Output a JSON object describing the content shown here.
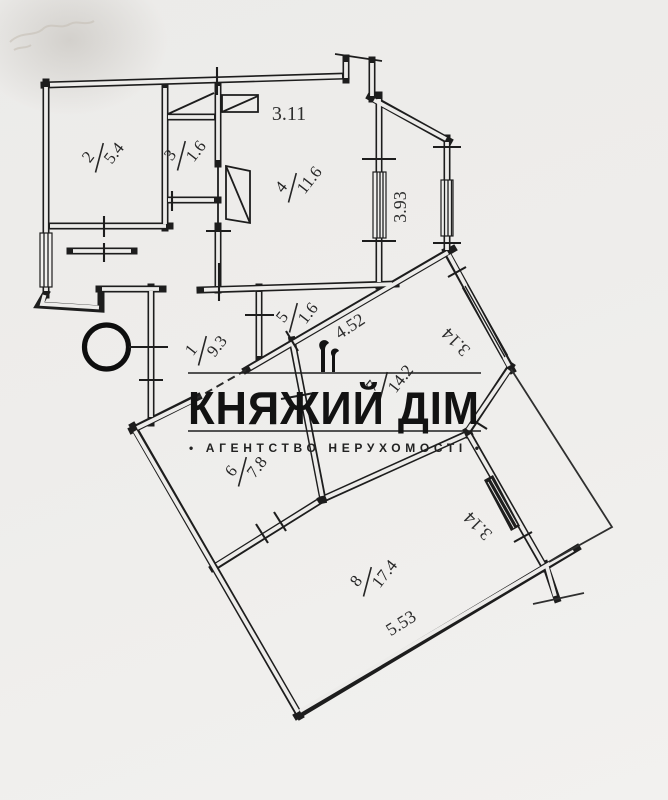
{
  "watermark": {
    "title": "КНЯЖИЙ ДІМ",
    "subtitle": "• АГЕНТСТВО  НЕРУХОМОСТІ •"
  },
  "rooms": [
    {
      "number": "1",
      "area": "9.3"
    },
    {
      "number": "2",
      "area": "5.4"
    },
    {
      "number": "3",
      "area": "1.6"
    },
    {
      "number": "4",
      "area": "11.6"
    },
    {
      "number": "5",
      "area": "1.6"
    },
    {
      "number": "6",
      "area": "7.8"
    },
    {
      "number": "7",
      "area": "14.2"
    },
    {
      "number": "8",
      "area": "17.4"
    }
  ],
  "dimensions": {
    "w311": "3.11",
    "w393": "3.93",
    "w452": "4.52",
    "w314_room7": "3.14",
    "w314_room8": "3.14",
    "w553": "5.53"
  }
}
